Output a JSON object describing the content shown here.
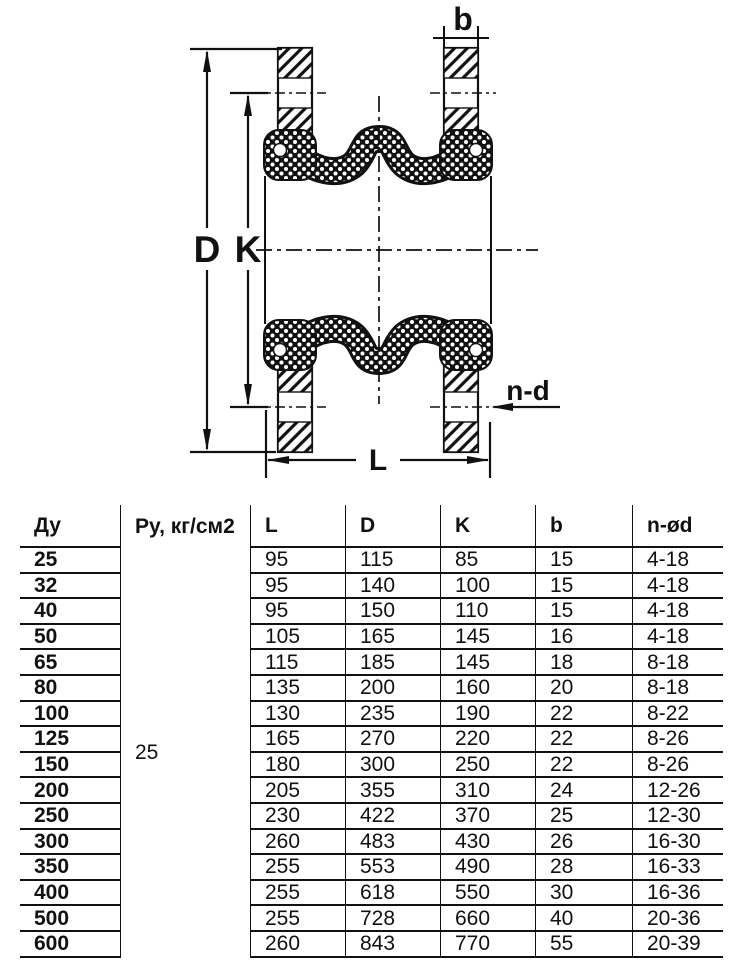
{
  "diagram": {
    "labels": {
      "D": "D",
      "K": "K",
      "b": "b",
      "L": "L",
      "nd": "n-d"
    }
  },
  "table": {
    "headers": [
      "Ду",
      "Ру, кг/см2",
      "L",
      "D",
      "K",
      "b",
      "n-ød"
    ],
    "pressure_value": "25",
    "rows": [
      {
        "du": "25",
        "l": "95",
        "d": "115",
        "k": "85",
        "b": "15",
        "nd": "4-18"
      },
      {
        "du": "32",
        "l": "95",
        "d": "140",
        "k": "100",
        "b": "15",
        "nd": "4-18"
      },
      {
        "du": "40",
        "l": "95",
        "d": "150",
        "k": "110",
        "b": "15",
        "nd": "4-18"
      },
      {
        "du": "50",
        "l": "105",
        "d": "165",
        "k": "145",
        "b": "16",
        "nd": "4-18"
      },
      {
        "du": "65",
        "l": "115",
        "d": "185",
        "k": "145",
        "b": "18",
        "nd": "8-18"
      },
      {
        "du": "80",
        "l": "135",
        "d": "200",
        "k": "160",
        "b": "20",
        "nd": "8-18"
      },
      {
        "du": "100",
        "l": "130",
        "d": "235",
        "k": "190",
        "b": "22",
        "nd": "8-22"
      },
      {
        "du": "125",
        "l": "165",
        "d": "270",
        "k": "220",
        "b": "22",
        "nd": "8-26"
      },
      {
        "du": "150",
        "l": "180",
        "d": "300",
        "k": "250",
        "b": "22",
        "nd": "8-26"
      },
      {
        "du": "200",
        "l": "205",
        "d": "355",
        "k": "310",
        "b": "24",
        "nd": "12-26"
      },
      {
        "du": "250",
        "l": "230",
        "d": "422",
        "k": "370",
        "b": "25",
        "nd": "12-30"
      },
      {
        "du": "300",
        "l": "260",
        "d": "483",
        "k": "430",
        "b": "26",
        "nd": "16-30"
      },
      {
        "du": "350",
        "l": "255",
        "d": "553",
        "k": "490",
        "b": "28",
        "nd": "16-33"
      },
      {
        "du": "400",
        "l": "255",
        "d": "618",
        "k": "550",
        "b": "30",
        "nd": "16-36"
      },
      {
        "du": "500",
        "l": "255",
        "d": "728",
        "k": "660",
        "b": "40",
        "nd": "20-36"
      },
      {
        "du": "600",
        "l": "260",
        "d": "843",
        "k": "770",
        "b": "55",
        "nd": "20-39"
      }
    ]
  }
}
